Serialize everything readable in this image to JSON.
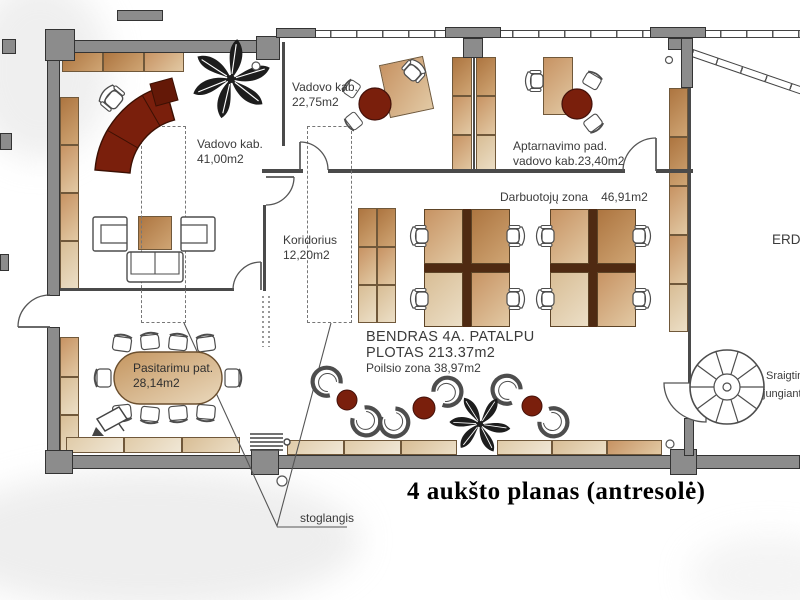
{
  "title": "4 aukšto planas (antresolė)",
  "rooms": {
    "vadovo_small": {
      "name": "Vadovo kab.",
      "area": "22,75m2"
    },
    "vadovo_large": {
      "name": "Vadovo kab.",
      "area": "41,00m2"
    },
    "aptarnavimo": {
      "name": "Aptarnavimo pad.",
      "area_line": "vadovo kab.23,40m2"
    },
    "koridorius": {
      "name": "Koridorius",
      "area": "12,20m2"
    },
    "darbuotoju": {
      "name": "Darbuotojų zona",
      "area": "46,91m2"
    },
    "pasitarimu": {
      "name": "Pasitarimu pat.",
      "area": "28,14m2"
    },
    "poilsio": {
      "name_area": "Poilsio zona 38,97m2"
    }
  },
  "summary": {
    "line1": "BENDRAS 4A. PATALPU",
    "line2": "PLOTAS 213.37m2"
  },
  "annotations": {
    "skylight": "stoglangis",
    "erdve_fragment": "ERD",
    "stairs_fragment_line1": "Sraigtin",
    "stairs_fragment_line2": "jungiant"
  },
  "colors": {
    "wall_fill": "#8c8c8c",
    "wall_outline": "#333333",
    "cabinet_dark": "#ad7540",
    "cabinet_light": "#ecdfc7",
    "accent_red": "#7a1f0c",
    "divider_brown": "#4f2a12",
    "label_text": "#3b3b3b"
  }
}
